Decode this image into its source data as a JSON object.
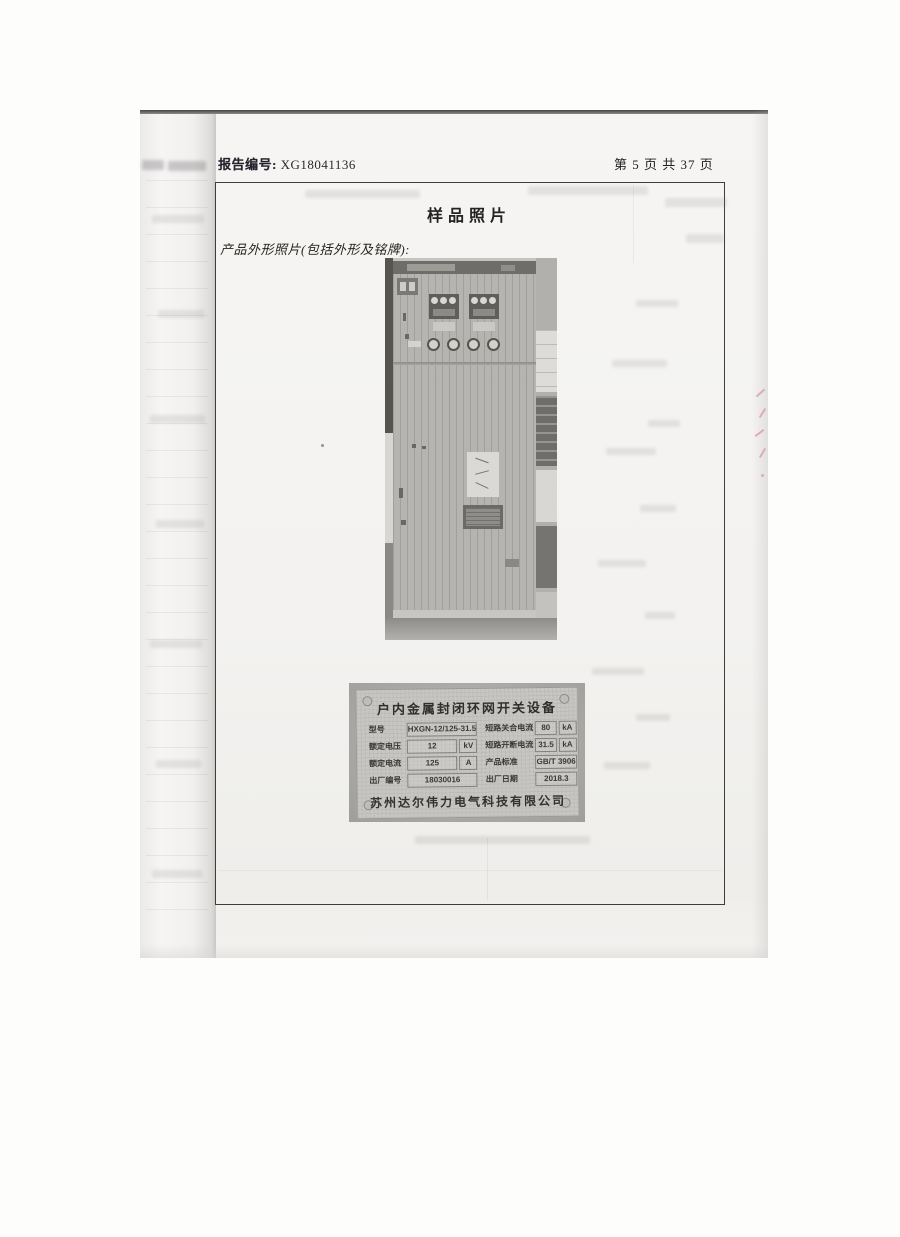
{
  "page": {
    "report_label": "报告编号:",
    "report_number": "XG18041136",
    "page_indicator": "第 5 页 共 37 页",
    "section_title": "样品照片",
    "caption": "产品外形照片(包括外形及铭牌):"
  },
  "nameplate": {
    "title": "户内金属封闭环网开关设备",
    "rows_left": [
      {
        "label": "型号",
        "value": "HXGN-12/125-31.5",
        "unit": ""
      },
      {
        "label": "额定电压",
        "value": "12",
        "unit": "kV"
      },
      {
        "label": "额定电流",
        "value": "125",
        "unit": "A"
      },
      {
        "label": "出厂编号",
        "value": "18030016",
        "unit": ""
      }
    ],
    "rows_right": [
      {
        "label": "短路关合电流",
        "value": "80",
        "unit": "kA"
      },
      {
        "label": "短路开断电流",
        "value": "31.5",
        "unit": "kA"
      },
      {
        "label": "产品标准",
        "value": "GB/T 3906",
        "unit": ""
      },
      {
        "label": "出厂日期",
        "value": "2018.3",
        "unit": ""
      }
    ],
    "company": "苏州达尔伟力电气科技有限公司"
  }
}
